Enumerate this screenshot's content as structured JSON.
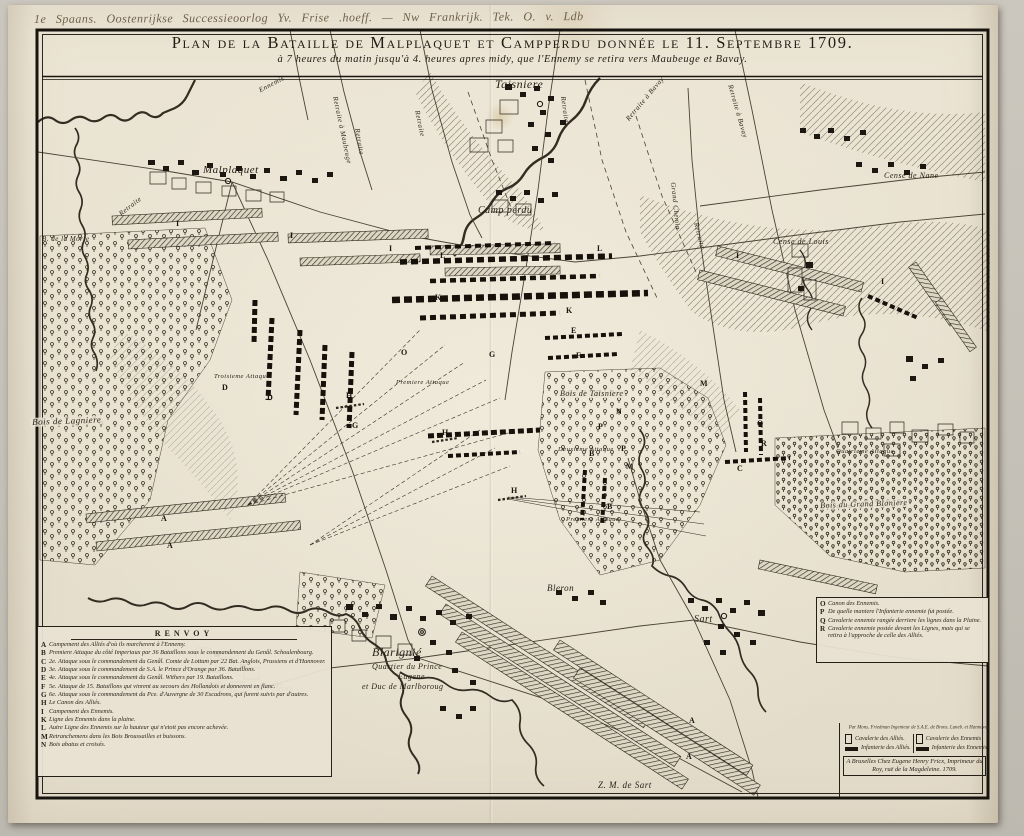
{
  "annotation": {
    "handwritten": "1e Spaans. Oostenrijkse Successieoorlog    Yv. Frise .hoeff.  — Nw Frankrijk.   Tek. O. v. Ldb"
  },
  "title": {
    "main": "Plan de la Bataille de Malplaquet et Campperdu donnée le 11. Septembre 1709.",
    "subtitle": "à 7 heures du matin jusqu'à 4. heures apres midy, que l'Ennemy se retira vers Maubeuge et Bavay."
  },
  "map": {
    "labels": [
      {
        "text": "Malplaquet"
      },
      {
        "text": "Taisniere"
      },
      {
        "text": "Camp perdu"
      },
      {
        "text": "Cense de Nane"
      },
      {
        "text": "Cense de Louis"
      },
      {
        "text": "B. de la Morte"
      },
      {
        "text": "Bois de Lagniere"
      },
      {
        "text": "Bois de Taisniere"
      },
      {
        "text": "Bois du Grand Blaniere"
      },
      {
        "text": "Blarignié"
      },
      {
        "text": "Quartier du Prince"
      },
      {
        "text": "Eugene"
      },
      {
        "text": "et Duc de Marlboroug"
      },
      {
        "text": "Aulnoit"
      },
      {
        "text": "† Croix"
      },
      {
        "text": "Bleron"
      },
      {
        "text": "Sart"
      },
      {
        "text": "Z. M. de Sart"
      },
      {
        "text": "Retraite"
      },
      {
        "text": "Retraite"
      },
      {
        "text": "Retraite à Maubeuge"
      },
      {
        "text": "Retraite à Bavay"
      },
      {
        "text": "Retraite à Bavay"
      },
      {
        "text": "Grand Chemin"
      },
      {
        "text": "Retraite"
      },
      {
        "text": "Ennemis"
      },
      {
        "text": "Troisieme Attaque"
      },
      {
        "text": "Premiere Attaque"
      },
      {
        "text": "Deuxieme Attaque"
      },
      {
        "text": "Premiere Attaque"
      },
      {
        "text": "Quatrieme Attaque"
      },
      {
        "text": "Retraite"
      },
      {
        "text": "Retraite"
      }
    ],
    "letters": [
      "I",
      "I",
      "I",
      "I",
      "I",
      "L",
      "L",
      "K",
      "E",
      "F",
      "H",
      "H",
      "H",
      "G",
      "G",
      "O",
      "A",
      "A",
      "A",
      "A",
      "B",
      "B",
      "C",
      "D",
      "D",
      "M",
      "M",
      "P",
      "P",
      "Q",
      "R",
      "N",
      "K"
    ]
  },
  "legend_left": {
    "title": "RENVOY",
    "items": [
      {
        "key": "A",
        "text": "Campement des Alliés d'où ils marcherent à l'Ennemy."
      },
      {
        "key": "B",
        "text": "Premiere Attaque du côté Imperiaux par 36 Bataillons sous le commandement du Genâl. Schoulenbourg."
      },
      {
        "key": "C",
        "text": "2e. Attaque sous le commandement du Genâl. Comte de Lottum par 22 Bat. Anglois, Prussiens et d'Hannover."
      },
      {
        "key": "D",
        "text": "3e. Attaque sous le commandement de S.A. le Prince d'Orange par 36. Bataillons."
      },
      {
        "key": "E",
        "text": "4e. Attaque sous le commandement du Genâl. Withers par 19. Bataillons."
      },
      {
        "key": "F",
        "text": "5e. Attaque de 15. Bataillons qui vinrent au secours des Hollandois et donnerent en flanc."
      },
      {
        "key": "G",
        "text": "6e. Attaque sous le commandement du Pce. d'Auvergne de 30 Escadrons, qui furent suivis par d'autres."
      },
      {
        "key": "H",
        "text": "Le Canon des Alliés."
      },
      {
        "key": "I",
        "text": "Campement des Ennemis."
      },
      {
        "key": "K",
        "text": "Ligne des Ennemis dans la plaine."
      },
      {
        "key": "L",
        "text": "Autre Ligne des Ennemis sur la hauteur qui n'etoit pas encore achevée."
      },
      {
        "key": "M",
        "text": "Retranchemens dans les Bois Broussailles et buissons."
      },
      {
        "key": "N",
        "text": "Bois abatus et croisés."
      }
    ]
  },
  "legend_right": {
    "items": [
      {
        "key": "O",
        "text": "Canon des Ennemis."
      },
      {
        "key": "P",
        "text": "De quelle maniere l'Infanterie ennemie fut postée."
      },
      {
        "key": "Q",
        "text": "Cavalerie ennemie rangée derriere les lignes dans la Plaine."
      },
      {
        "key": "R",
        "text": "Cavalerie ennemie postée devant les Lignes, mais qui se retira à l'approche de celle des Alliés."
      }
    ]
  },
  "cartouche": {
    "engineer": "Par Mons. Friedman Ingenieur de S.A.E. de Brons. Luneb. et Hannover.",
    "symbols": {
      "allies_cavalry": "Cavalerie des Alliés.",
      "allies_infantry": "Infanterie des Alliés.",
      "enemy_cavalry": "Cavalerie des Ennemis",
      "enemy_infantry": "Infanterie des Ennemis"
    },
    "imprint": "A Bruxelles Chez Eugene Henry Fricx, Imprimeur du Roy, ruë de la Magdeleine. 1709."
  },
  "colors": {
    "paper": "#e9e2d1",
    "margin": "#c8c4bb",
    "ink": "#241f17"
  }
}
